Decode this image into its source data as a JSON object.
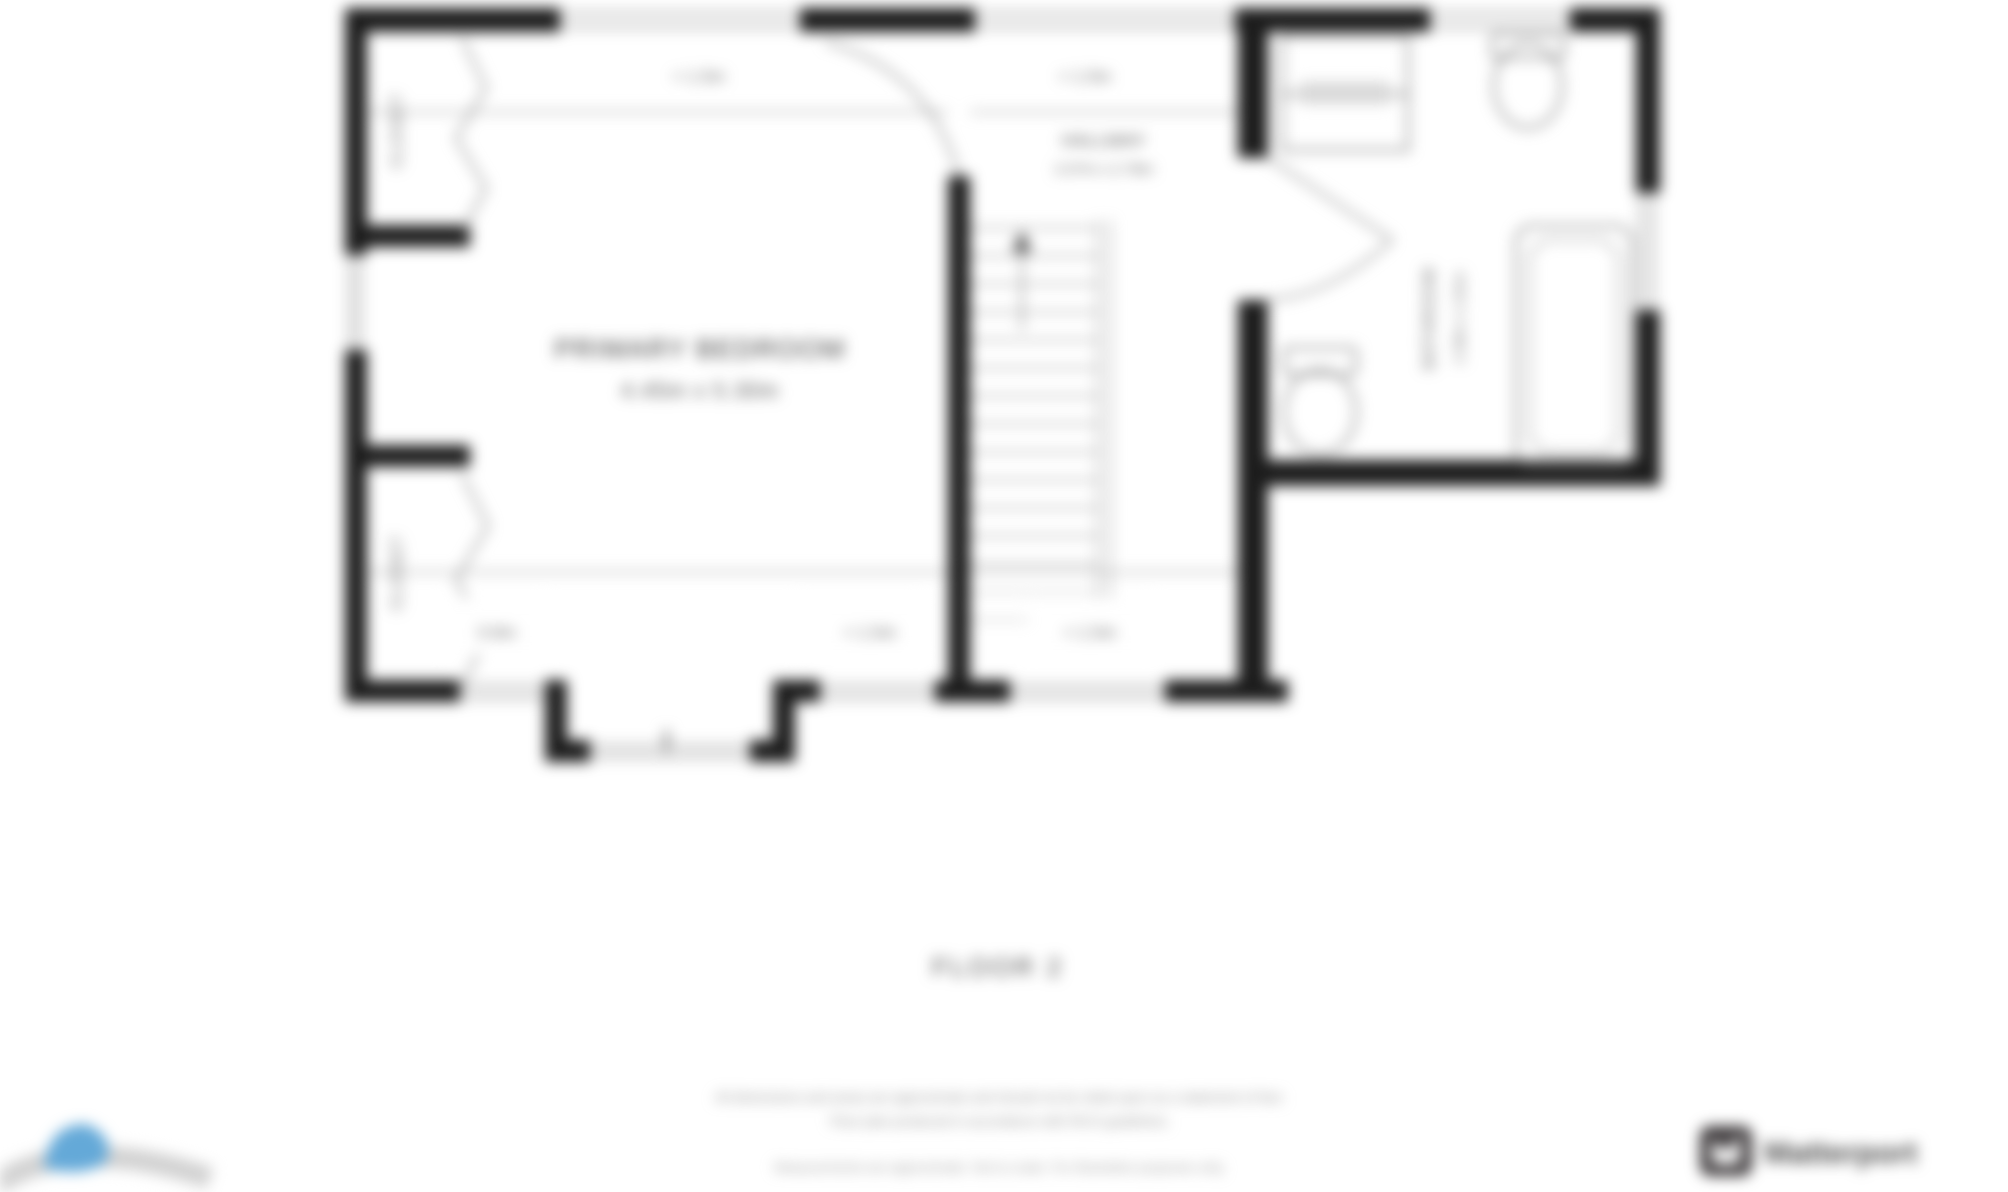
{
  "floor_plan": {
    "rooms": {
      "primary_bedroom": {
        "label": "PRIMARY BEDROOM",
        "dims": "4.45m x 5.30m"
      },
      "hallway": {
        "label": "HALLWAY",
        "dims": "2.07m x 2.78m"
      },
      "bathroom": {
        "label": "BATHROOM",
        "dims": "2.39m x 1.81m"
      },
      "closet_top": {
        "label": "CLOSET"
      },
      "closet_bottom": {
        "label": "CLOSET"
      }
    },
    "window_labels": {
      "bedroom_top": "< 1.5m",
      "hallway_top": "< 1.5m",
      "closet_bottom": "0.9m",
      "bedroom_bottom": "< 1.5m",
      "hallway_bottom": "< 1.5m"
    },
    "floor_label": "FLOOR 2"
  },
  "footer": {
    "line1": "All dimensions and areas are approximate and should not be relied upon as a statement of fact.",
    "line2": "Floor plan produced in accordance with RICS guidelines.",
    "line3": "Measurements are approximate. Not to scale. For illustrative purposes only."
  },
  "branding": {
    "matterport_label": "Matterport"
  },
  "colors": {
    "wall": "#1c1c1c",
    "thin_line": "#8a8a8a",
    "label_text": "#555555",
    "footer_text": "#8e8e8e",
    "logo_blue": "#64a9d8",
    "logo_dark": "#3b3739"
  }
}
